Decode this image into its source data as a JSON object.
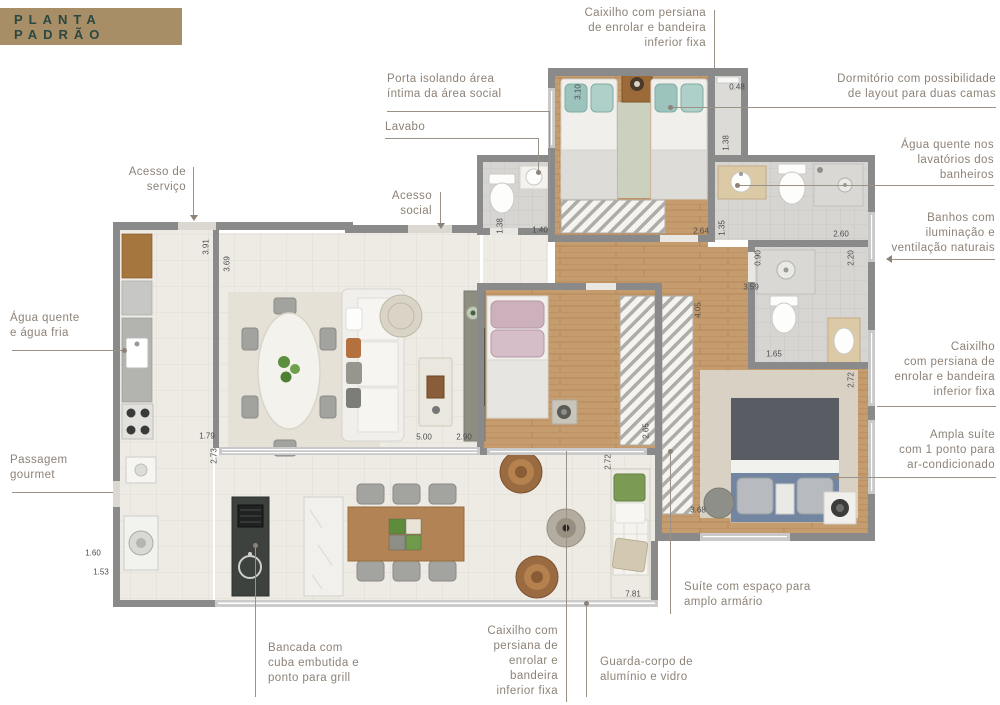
{
  "header": {
    "title": "PLANTA PADRÃO"
  },
  "callouts": {
    "caixilho_top": {
      "text": "Caixilho com persiana\nde enrolar e bandeira\ninferior fixa"
    },
    "dormitorio": {
      "text": "Dormitório com possibilidade\nde layout para duas camas"
    },
    "agua_banheiros": {
      "text": "Água quente nos\nlavatórios dos\nbanheiros"
    },
    "banhos": {
      "text": "Banhos com\niluminação e\nventilação naturais"
    },
    "caixilho_right": {
      "text": "Caixilho\ncom persiana de\nenrolar e bandeira\ninferior fixa"
    },
    "ampla_suite": {
      "text": "Ampla suíte\ncom 1 ponto para\nar-condicionado"
    },
    "suite_armario": {
      "text": "Suíte com espaço para\namplo armário"
    },
    "guarda_corpo": {
      "text": "Guarda-corpo de\nalumínio e vidro"
    },
    "caixilho_bottom": {
      "text": "Caixilho com\npersiana de\nenrolar e\nbandeira\ninferior fixa"
    },
    "bancada": {
      "text": "Bancada com\ncuba embutida e\nponto para grill"
    },
    "passagem_gourmet": {
      "text": "Passagem\ngourmet"
    },
    "agua_quente_fria": {
      "text": "Água quente\ne água fria"
    },
    "acesso_servico": {
      "text": "Acesso de\nserviço"
    },
    "acesso_social": {
      "text": "Acesso\nsocial"
    },
    "lavabo": {
      "text": "Lavabo"
    },
    "porta_isolando": {
      "text": "Porta isolando área\níntima da área social"
    }
  },
  "plan": {
    "dimensions": [
      {
        "text": "3.91",
        "x": 206,
        "y": 247,
        "vertical": true
      },
      {
        "text": "3.69",
        "x": 227,
        "y": 264,
        "vertical": true
      },
      {
        "text": "1.79",
        "x": 207,
        "y": 436,
        "vertical": false
      },
      {
        "text": "2.73",
        "x": 214,
        "y": 456,
        "vertical": true
      },
      {
        "text": "1.60",
        "x": 93,
        "y": 553,
        "vertical": false
      },
      {
        "text": "1.53",
        "x": 101,
        "y": 572,
        "vertical": false
      },
      {
        "text": "1.38",
        "x": 500,
        "y": 226,
        "vertical": true
      },
      {
        "text": "1.40",
        "x": 540,
        "y": 230,
        "vertical": false
      },
      {
        "text": "3.10",
        "x": 578,
        "y": 92,
        "vertical": true
      },
      {
        "text": "0.48",
        "x": 737,
        "y": 87,
        "vertical": false
      },
      {
        "text": "1.38",
        "x": 726,
        "y": 143,
        "vertical": true
      },
      {
        "text": "1.35",
        "x": 722,
        "y": 228,
        "vertical": true
      },
      {
        "text": "2.64",
        "x": 701,
        "y": 231,
        "vertical": false
      },
      {
        "text": "2.60",
        "x": 841,
        "y": 234,
        "vertical": false
      },
      {
        "text": "2.20",
        "x": 851,
        "y": 258,
        "vertical": true
      },
      {
        "text": "0.90",
        "x": 758,
        "y": 258,
        "vertical": true
      },
      {
        "text": "3.59",
        "x": 751,
        "y": 287,
        "vertical": false
      },
      {
        "text": "1.65",
        "x": 774,
        "y": 354,
        "vertical": false
      },
      {
        "text": "2.72",
        "x": 851,
        "y": 380,
        "vertical": true
      },
      {
        "text": "4.05",
        "x": 698,
        "y": 310,
        "vertical": true
      },
      {
        "text": "2.65",
        "x": 646,
        "y": 431,
        "vertical": true
      },
      {
        "text": "2.72",
        "x": 608,
        "y": 462,
        "vertical": true
      },
      {
        "text": "5.00",
        "x": 424,
        "y": 437,
        "vertical": false
      },
      {
        "text": "2.90",
        "x": 464,
        "y": 437,
        "vertical": false
      },
      {
        "text": "3.68",
        "x": 698,
        "y": 510,
        "vertical": false
      },
      {
        "text": "7.81",
        "x": 633,
        "y": 594,
        "vertical": false
      }
    ]
  },
  "colors": {
    "header_bg": "#a78e66",
    "header_text": "#2b4741",
    "label_text": "#8d8277",
    "leader": "#9a9187",
    "wall": "#8a8a8a",
    "wood_floor": "#c59c6e",
    "tile_floor": "#edebe4",
    "bath_floor": "#d6d5d2",
    "teal_pillow": "#9cc4bd",
    "pink_pillow": "#ccb0bc",
    "navy_bed": "#7286a2",
    "brown_chair": "#9a6a41",
    "plant_green": "#5c8f3d"
  }
}
